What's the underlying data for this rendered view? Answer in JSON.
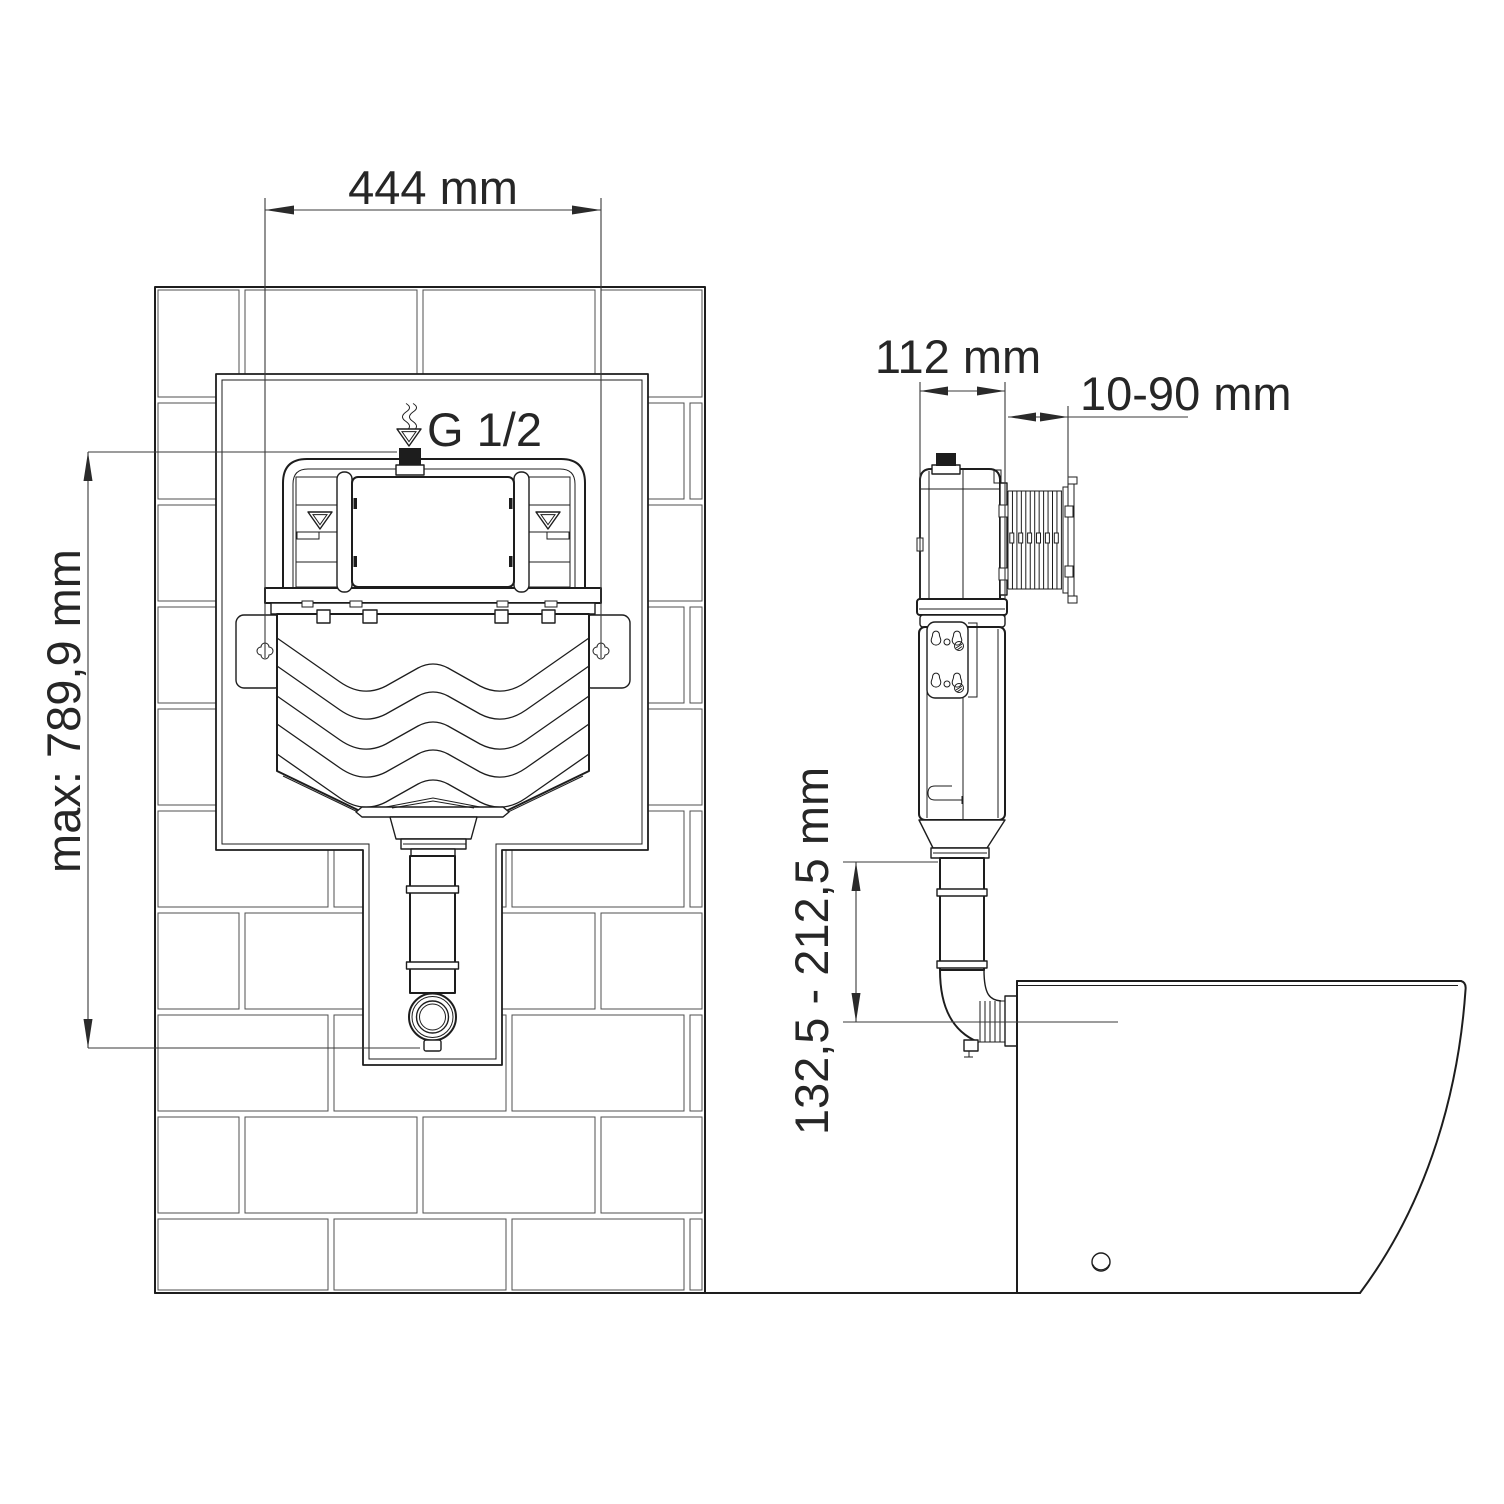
{
  "drawing": {
    "type": "installation-diagram",
    "subject": "concealed-toilet-cistern",
    "views": {
      "front": {
        "name": "front-view-in-brick-wall",
        "dimensions": [
          {
            "name": "width",
            "label": "444 mm"
          },
          {
            "name": "max_height",
            "label": "max: 789,9 mm"
          }
        ],
        "inlet_label": "G 1/2"
      },
      "side": {
        "name": "side-view-with-toilet-bowl",
        "dimensions": [
          {
            "name": "depth",
            "label": "112 mm"
          },
          {
            "name": "wall_plate_range",
            "label": "10-90 mm"
          },
          {
            "name": "flush_pipe_height_range",
            "label": "132,5 - 212,5 mm"
          }
        ]
      }
    },
    "colors": {
      "line": "#1d1d1d",
      "text": "#262626",
      "brick_line": "#4f4f4f",
      "background": "#ffffff"
    }
  }
}
